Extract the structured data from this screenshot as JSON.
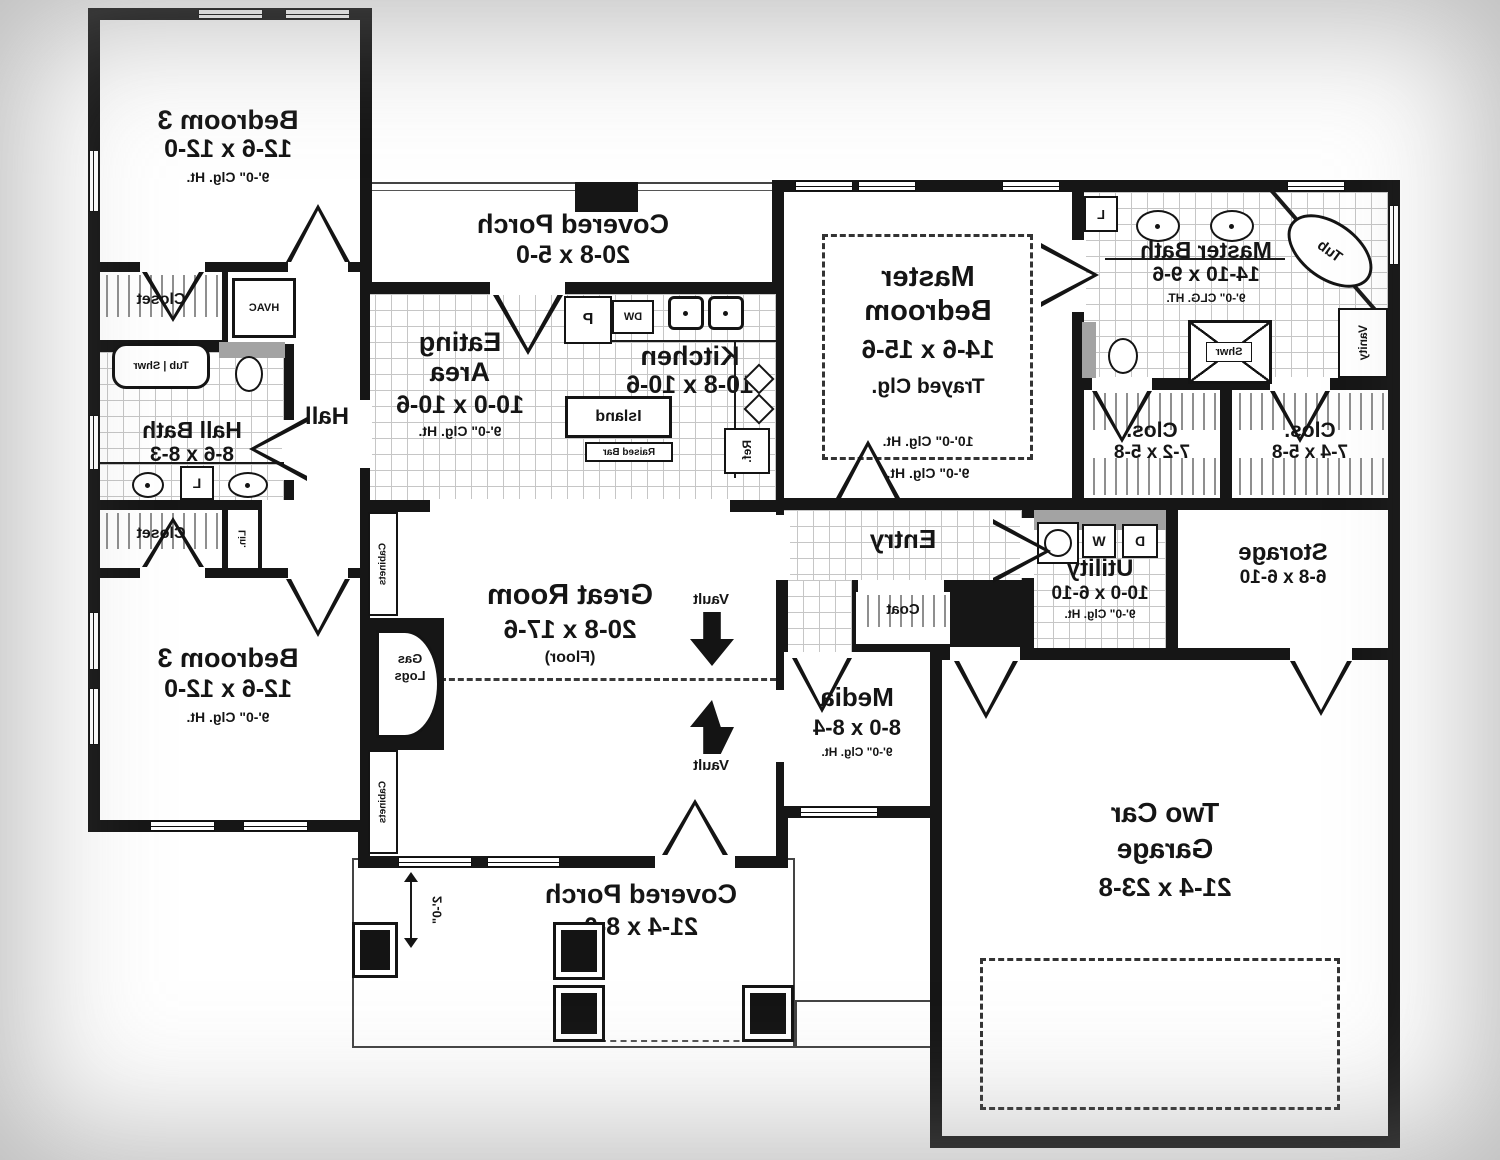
{
  "rooms": {
    "bedroom_tr": {
      "name": "Bedroom 3",
      "dims": "12-6 x 12-0",
      "clg": "9'-0\" Clg. Ht."
    },
    "porch_top": {
      "name": "Covered Porch",
      "dims": "20-8 x 5-0"
    },
    "eating": {
      "line1": "Eating",
      "line2": "Area",
      "dims": "10-0 x 10-6",
      "clg": "9'-0\" Clg. Ht."
    },
    "kitchen": {
      "name": "Kitchen",
      "dims": "10-8 x 10-6"
    },
    "master_bed": {
      "line1": "Master",
      "line2": "Bedroom",
      "dims": "14-6 x 15-6",
      "tray": "Trayed Clg.",
      "clg_in": "10'-0\" Clg. Ht.",
      "clg_out": "9'-0\" Clg. Ht."
    },
    "master_bath": {
      "name": "Master Bath",
      "dims": "14-10 x 9-6",
      "clg": "9'-0\" CLG. HT."
    },
    "hall": {
      "name": "Hall"
    },
    "hall_bath": {
      "name": "Hall Bath",
      "dims": "8-6 x 8-3"
    },
    "closet_top": {
      "name": "Closet"
    },
    "closet_bottom": {
      "name": "Closet"
    },
    "clos1": {
      "name": "Clos.",
      "dims": "7-2 x 5-8"
    },
    "clos2": {
      "name": "Clos.",
      "dims": "7-4 x 5-8"
    },
    "entry": {
      "name": "Entry"
    },
    "coat": {
      "name": "Coat"
    },
    "utility": {
      "name": "Utility",
      "dims": "10-0 x 6-10",
      "clg": "9'-0\" Clg. Ht."
    },
    "storage": {
      "name": "Storage",
      "dims": "6-8 x 6-10"
    },
    "great": {
      "name": "Great Room",
      "dims": "20-8 x 17-6",
      "floor": "(Floor)"
    },
    "media": {
      "name": "Media",
      "dims": "8-0 x 8-4",
      "clg": "9'-0\" Clg. Ht."
    },
    "bedroom_br": {
      "name": "Bedroom 3",
      "dims": "12-6 x 12-0",
      "clg": "9'-0\" Clg. Ht."
    },
    "garage": {
      "line1": "Two Car",
      "line2": "Garage",
      "dims": "21-4 x 23-8"
    },
    "porch_bottom": {
      "name": "Covered Porch",
      "dims": "21-4 x 8-0"
    }
  },
  "fixtures": {
    "hvac": "HVAC",
    "tub_shwr": "Tub | Shwr",
    "linen": "L",
    "lin": "Lin.",
    "tub": "Tub",
    "vanity": "Vanity",
    "shower": "Shwr",
    "island": "Island",
    "raised_bar": "Raised Bar",
    "ref": "Ref.",
    "pantry": "P",
    "dw": "DW",
    "washer": "W",
    "dryer": "D",
    "gas": "Gas",
    "logs": "Logs",
    "cabinets": "Cabinets",
    "vault": "Vault"
  },
  "dimensions": {
    "porch_depth": "2'-0\""
  },
  "colors": {
    "wall": "#161616",
    "grid_line": "#c6c6c6",
    "counter_gray": "#a3a3a3",
    "paper": "#ffffff"
  }
}
